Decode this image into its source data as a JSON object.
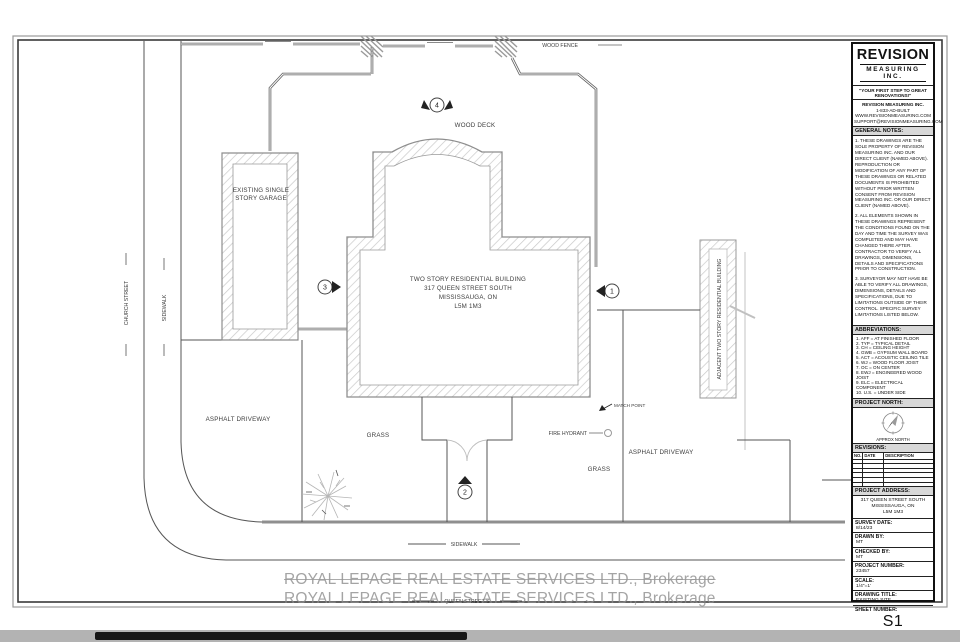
{
  "colors": {
    "hatch": "#c9c9c9",
    "wall_stroke": "#8e8e8e",
    "fence": "#5e5e5e",
    "line": "#555555",
    "label": "#3c3c3c",
    "watermark": "#9b9b9b",
    "header_bg": "#d8d8d8"
  },
  "drawing": {
    "labels": {
      "wood_fence": "WOOD FENCE",
      "wood_deck": "WOOD DECK",
      "garage_line1": "EXISTING SINGLE",
      "garage_line2": "STORY GARAGE",
      "house_line1": "TWO STORY RESIDENTIAL BUILDING",
      "house_line2": "317 QUEEN STREET SOUTH",
      "house_line3": "MISSISSAUGA, ON",
      "house_line4": "L5M 1M3",
      "church_street": "CHURCH STREET",
      "sidewalk_west": "SIDEWALK",
      "asphalt_driveway_west": "ASPHALT DRIVEWAY",
      "grass_west": "GRASS",
      "match_point": "MATCH POINT",
      "fire_hydrant": "FIRE HYDRANT",
      "asphalt_driveway_east": "ASPHALT DRIVEWAY",
      "grass_east": "GRASS",
      "adjacent_building": "ADJACENT TWO STORY RESIDENTIAL BUILDING",
      "sidewalk_south": "SIDEWALK",
      "queen_street": "QUEEN STREET S"
    },
    "markers": {
      "m1": "1",
      "m2": "2",
      "m3": "3",
      "m4": "4"
    },
    "watermark": {
      "line1": "ROYAL LEPAGE REAL ESTATE SERVICES LTD., Brokerage",
      "line2": "ROYAL LEPAGE REAL ESTATE SERVICES LTD., Brokerage"
    }
  },
  "titleblock": {
    "logo": {
      "line1": "REVISION",
      "line2": "MEASURING INC."
    },
    "tagline": "\"YOUR FIRST STEP TO GREAT RENOVATIONS!\"",
    "contact": {
      "line1": "REVISION MEASURING INC.",
      "line2": "1-833-AD-BUILT",
      "line3": "WWW.REVISIONMEASURING.COM",
      "line4": "SUPPORT@REVISIONMEASURING.COM"
    },
    "general_notes": {
      "heading": "GENERAL NOTES:",
      "note1": "1. THESE DRAWINGS ARE THE SOLE PROPERTY OF REVISION MEASURING INC. AND OUR DIRECT CLIENT (NAMED ABOVE). REPRODUCTION OR MODIFICATION OF ANY PART OF THESE DRAWINGS OR RELATED DOCUMENTS IS PROHIBITED WITHOUT PRIOR WRITTEN CONSENT FROM REVISION MEASURING INC. OR OUR DIRECT CLIENT (NAMED ABOVE).",
      "note2": "2. ALL ELEMENTS SHOWN IN THESE DRAWINGS REPRESENT THE CONDITIONS FOUND ON THE DAY AND TIME THE SURVEY WAS COMPLETED AND MAY HAVE CHANGED THERE AFTER. CONTRACTOR TO VERIFY ALL DRAWINGS, DIMENSIONS, DETAILS AND SPECIFICATIONS PRIOR TO CONSTRUCTION.",
      "note3": "3. SURVEYOR MAY NOT HAVE BE ABLE TO VERIFY ALL DRAWINGS, DIMENSIONS, DETAILS AND SPECIFICATIONS, DUE TO LIMITATIONS OUTSIDE OF THEIR CONTROL. SPECIFIC SURVEY LIMITATIONS LISTED BELOW."
    },
    "abbreviations": {
      "heading": "ABBREVIATIONS:",
      "items": [
        "1. AFF = AT FINISHED FLOOR",
        "2. TYP = TYPICAL DETAIL",
        "3. CH = CEILING HEIGHT",
        "4. GWB = GYPSUM WALL BOARD",
        "5. ACT = ACOUSTIC CEILING TILE",
        "6. WJ = WOOD FLOOR JOIST",
        "7. OC = ON CENTER",
        "8. EWJ = ENGINEERED WOOD JOIST",
        "9. ELC = ELECTRICAL COMPONENT",
        "10. U.S. = UNDER SIDE"
      ]
    },
    "project_north": {
      "heading": "PROJECT NORTH:",
      "caption": "APPROX NORTH"
    },
    "revisions": {
      "heading": "REVISIONS:",
      "columns": [
        "NO.",
        "DATE",
        "DESCRIPTION"
      ]
    },
    "project_address": {
      "heading": "PROJECT ADDRESS:",
      "line1": "317 QUEEN STREET SOUTH",
      "line2": "MISSISSAUGA, ON",
      "line3": "L5M 1M3"
    },
    "fields": {
      "survey_date": {
        "label": "SURVEY DATE:",
        "value": "8/14/23"
      },
      "drawn_by": {
        "label": "DRAWN BY:",
        "value": "MT"
      },
      "checked_by": {
        "label": "CHECKED BY:",
        "value": "MT"
      },
      "project_number": {
        "label": "PROJECT NUMBER:",
        "value": "23457"
      },
      "scale": {
        "label": "SCALE:",
        "value": "1/4\"=1'"
      },
      "drawing_title": {
        "label": "DRAWING TITLE:",
        "value": "EXISTING SITE"
      },
      "sheet_number": {
        "label": "SHEET NUMBER:",
        "value": "S1"
      }
    }
  }
}
